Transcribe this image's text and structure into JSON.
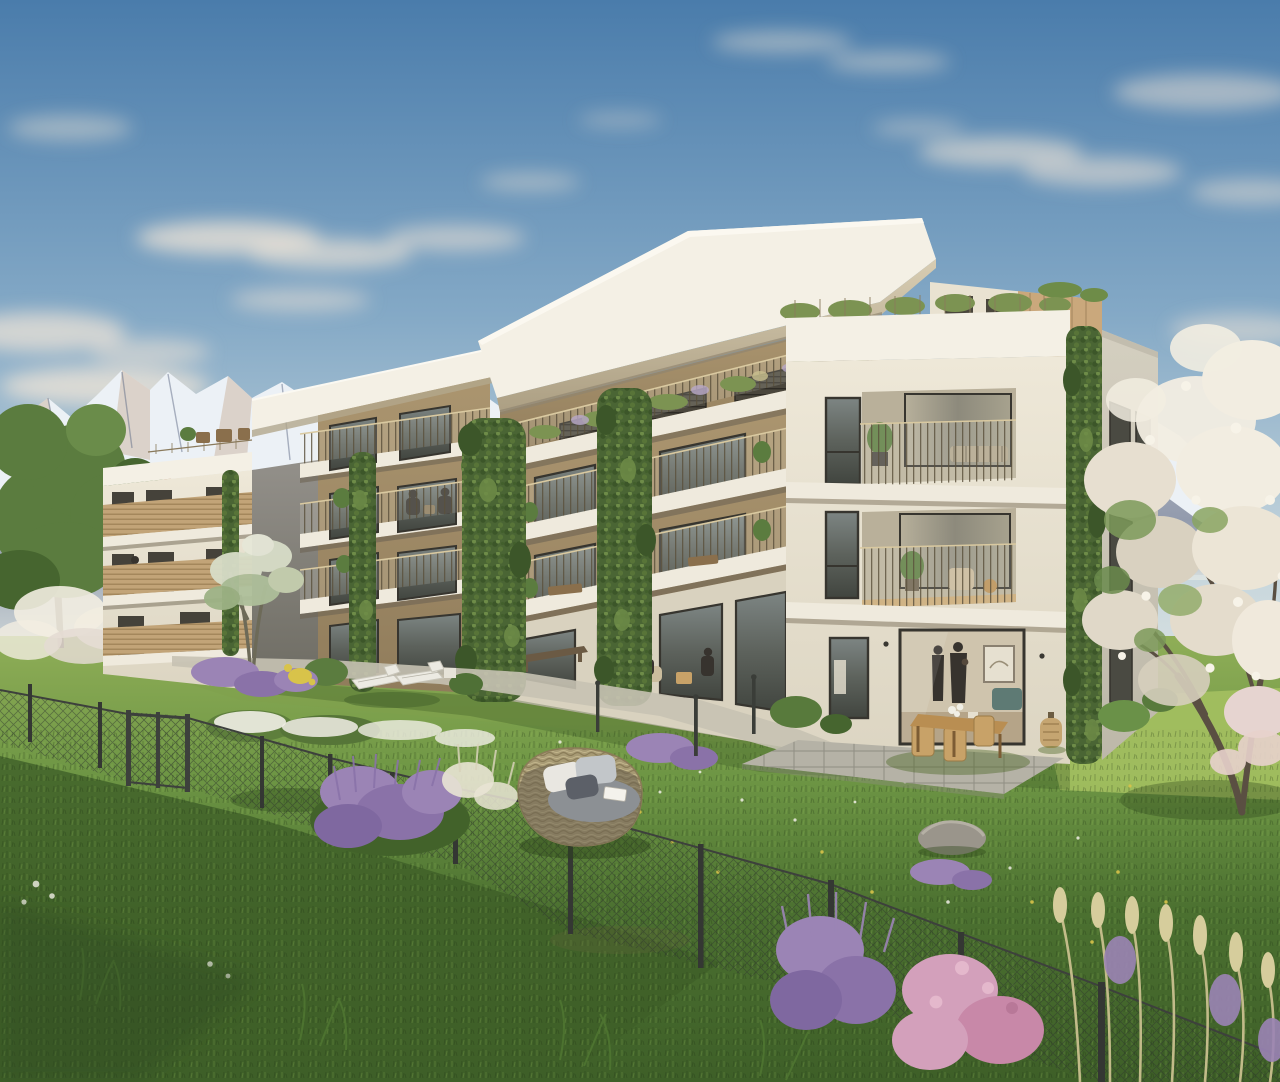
{
  "meta": {
    "title": "Photorealistic architectural rendering of a modern four-storey apartment residence with white slab balconies, rooftop terraces and climbing greenery, set in a wildflower meadow garden in front of snow-capped alpine mountains under a blue sky"
  },
  "scene": {
    "sky": "clear blue sky with soft warm clouds",
    "mountains": "snow-capped alpine range behind the buildings",
    "left_house": "neighbouring house with terracotta hip roof",
    "left_wing": "set-back left apartment wing with wood-slat balcony rails and roof terrace",
    "right_wing": "main apartment wing with cantilevered white roof slab and penthouse terrace",
    "corner_block": "sunlit corner volume with balconies, ground-floor apartment and ivy-clad corner",
    "garden": "meadow lawn with lavender, daisies, chain-link fence and gate",
    "furniture": "sun loungers, rattan daybed, outdoor dining set, lantern",
    "blossom_tree": "large white-blossoming tree at the right edge"
  },
  "palette": {
    "sky_top": "#4a7cab",
    "sky_mid": "#84a9c6",
    "sky_low": "#c2d3db",
    "sky_horizon": "#dde4e2",
    "cloud": "#f2e6d7",
    "mountain_rock": "#8b93a6",
    "mountain_rock_dark": "#6d7890",
    "mountain_snow": "#ecf1f6",
    "mountain_warm": "#c2a285",
    "roof_white": "#f4f0e5",
    "fascia_front": "#e9e3d2",
    "soffit": "#c3b89e",
    "wall_tan": "#ac9670",
    "wall_tan_shade": "#907c5b",
    "wall_cream": "#eee8d8",
    "wall_cream_shade": "#dcd5c2",
    "wall_side": "#d4cfc0",
    "wall_grey": "#8d8a80",
    "slab_white": "#efeadd",
    "window_frame": "#37352f",
    "glass": "#5d625c",
    "glass_light": "#9aa49f",
    "curtain": "#c3b89f",
    "rail_dark": "#5a503c",
    "rail_top": "#d9c9a0",
    "wood_rail": "#c2a478",
    "ivy": "#4a6534",
    "ivy_dark": "#3c5629",
    "ivy_light": "#6e8c48",
    "lawn_light": "#8fae57",
    "lawn_mid": "#6d9544",
    "lawn_dark": "#4b7030",
    "lawn_deep": "#3e5f28",
    "lawn_sun": "#a4c061",
    "path": "#c7c2b2",
    "patio": "#b5b2a6",
    "fence": "#3d403c",
    "lavender": "#9b84b5",
    "lavender_deep": "#7f68a0",
    "pink_flower": "#d3a0bb",
    "white_flower": "#f1efe6",
    "yellow_flower": "#d8c34a",
    "dry_grass": "#c9c08e",
    "blossom": "#f2ede1",
    "blossom_shade": "#d9d1c0",
    "branch": "#5a4f42",
    "trunk": "#4b4336",
    "tree_green": "#5b7c3f",
    "tree_green_dark": "#46652f",
    "wood_furniture": "#b98e52",
    "rattan": "#c8a268",
    "daybed_body": "#a79a74",
    "cushion_grey": "#8c9094",
    "terracotta": "#ad6b4c",
    "stone": "#9a958b",
    "people": "#37332e"
  }
}
